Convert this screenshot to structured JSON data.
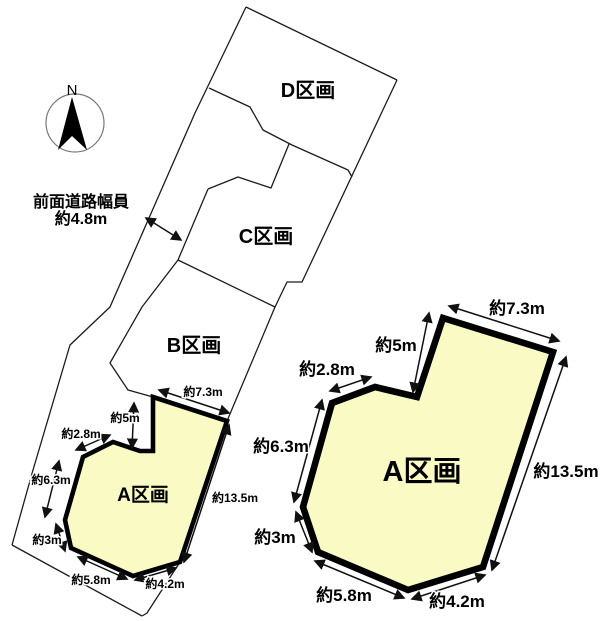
{
  "compass": {
    "north": "N"
  },
  "road": {
    "line1": "前面道路幅員",
    "line2": "約4.8m"
  },
  "parcels": {
    "a": "A区画",
    "b": "B区画",
    "c": "C区画",
    "d": "D区画"
  },
  "dims": {
    "d73": "約7.3m",
    "d5": "約5m",
    "d28": "約2.8m",
    "d63": "約6.3m",
    "d135": "約13.5m",
    "d3": "約3m",
    "d58": "約5.8m",
    "d42": "約4.2m"
  },
  "colors": {
    "parcel_fill": "#fafac5",
    "line": "#1c1c1c"
  }
}
